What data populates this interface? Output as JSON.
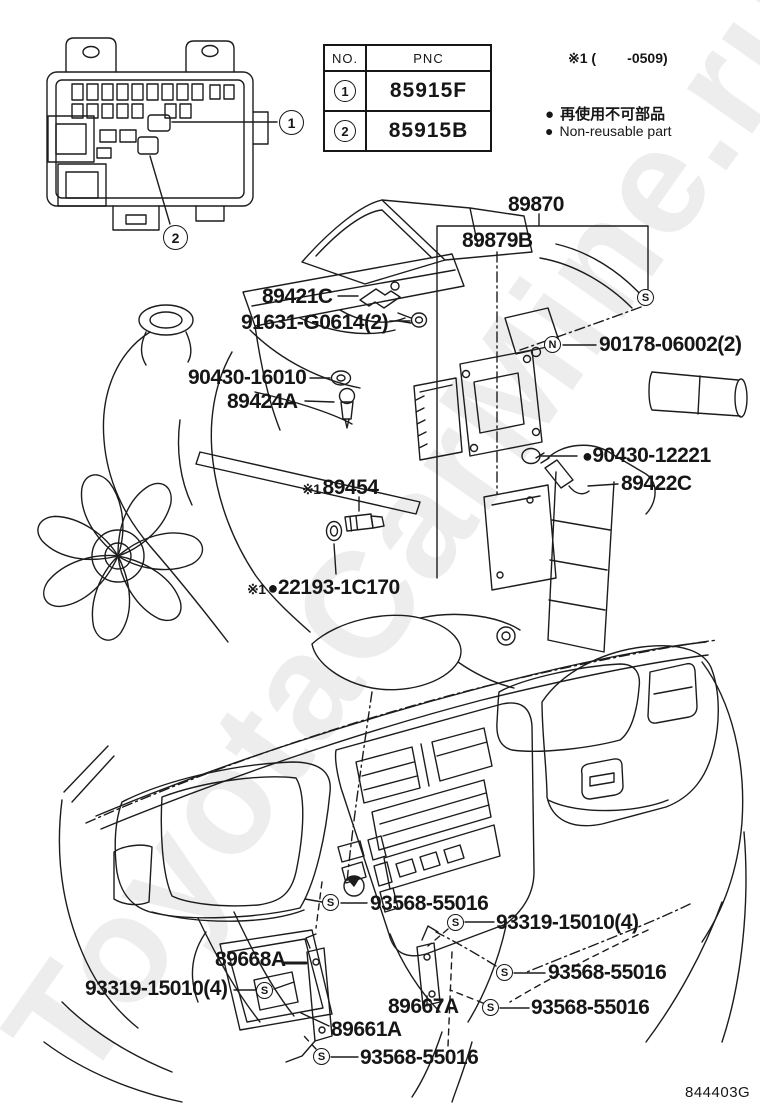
{
  "doc": {
    "drawing_code": "844403G",
    "watermark": "ToyotaCarMine.ru"
  },
  "table": {
    "col_no": "NO.",
    "col_pnc": "PNC",
    "rows": [
      {
        "no": "1",
        "pnc": "85915F"
      },
      {
        "no": "2",
        "pnc": "85915B"
      }
    ]
  },
  "notes": {
    "applicability": "※1 (        -0509)",
    "bullet": "●",
    "legend_jp": "再使用不可部品",
    "legend_en": "Non-reusable part"
  },
  "callouts": {
    "one": "1",
    "two": "2"
  },
  "markers": {
    "s": "S",
    "n": "N"
  },
  "labels": {
    "p89870": {
      "text": "89870"
    },
    "p89879b": {
      "text": "89879B"
    },
    "p90178": {
      "text": "90178-06002(2)"
    },
    "p89421c": {
      "text": "89421C"
    },
    "p91631": {
      "text": "91631-G0614(2)"
    },
    "p90430_16010": {
      "text": "90430-16010"
    },
    "p89424a": {
      "text": "89424A"
    },
    "p90430_12221": {
      "bullet": "●",
      "text": "90430-12221"
    },
    "p89422c": {
      "text": "89422C"
    },
    "p89454": {
      "prefix": "※1",
      "text": "89454"
    },
    "p22193": {
      "prefix": "※1",
      "bullet": "●",
      "text": "22193-1C170"
    },
    "s_top": {
      "text": "93568-55016"
    },
    "s_mid_right": {
      "text": "93319-15010(4)"
    },
    "p89668a": {
      "text": "89668A"
    },
    "p93319_left": {
      "text": "93319-15010(4)"
    },
    "s_right_upper": {
      "text": "93568-55016"
    },
    "p89667a": {
      "text": "89667A"
    },
    "s_right_lower": {
      "text": "93568-55016"
    },
    "p89661a": {
      "text": "89661A"
    },
    "s_bottom": {
      "text": "93568-55016"
    }
  }
}
